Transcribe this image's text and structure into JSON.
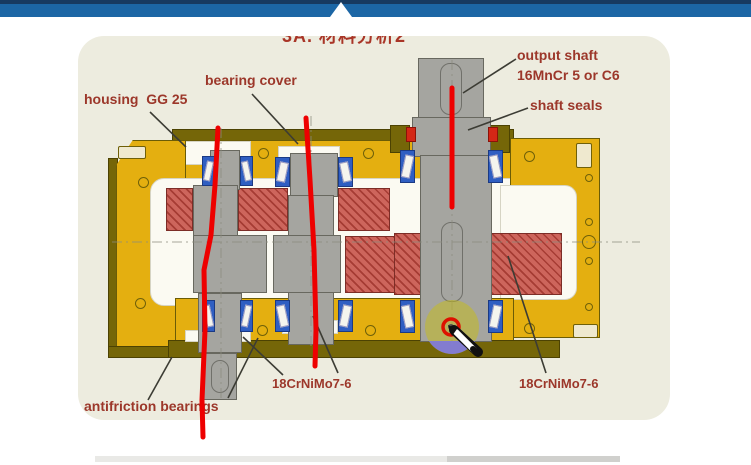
{
  "header": {
    "bar_color": "#1c66a5",
    "top_strip_color": "#173a61"
  },
  "slide": {
    "title": "3A. 材料分析2",
    "labels": {
      "housing": "housing  GG 25",
      "bearing_cover": "bearing cover",
      "output_shaft": "output shaft",
      "output_shaft_material": "16MnCr 5 or C6",
      "shaft_seals": "shaft seals",
      "gear_material_center": "18CrNiMo7-6",
      "gear_material_right": "18CrNiMo7-6",
      "antifriction_bearings": "antifriction bearings"
    },
    "colors": {
      "panel_beige": "#edecdf",
      "housing_yellow": "#e4af10",
      "housing_olive": "#756608",
      "shaft_gray": "#a5a5a0",
      "gear_red": "#cd655c",
      "bearing_blue": "#2f5ec2",
      "label_red": "#9c372a",
      "annotation_red": "#ee0000",
      "highlight_yellow": "rgba(200,190,20,0.5)",
      "highlight_purple": "rgba(128,122,228,0.9)"
    },
    "icons": {
      "pen_cursor": "marker-pen pointer",
      "highlight": "laser-highlight circle"
    }
  }
}
